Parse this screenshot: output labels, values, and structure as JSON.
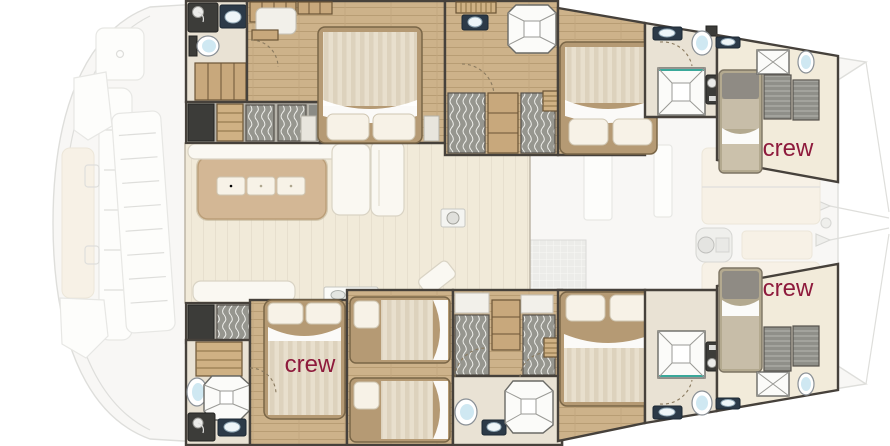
{
  "plan": {
    "labels": {
      "port_forepeak": "crew",
      "starboard_forepeak": "crew",
      "starboard_forward_cabin": "crew"
    },
    "colors": {
      "crew_text": "#8e1a3c",
      "wood_floor": "#cdb28a",
      "wall": "#46413b",
      "bathroom_floor": "#e9e2d4",
      "salon_floor": "#f1ead9",
      "forepeak_floor": "#f2ebda",
      "table": "#d3b795",
      "upholstery": "#faf8f2",
      "ghost_deck": "#f4f3f0",
      "ghost_line": "#cbcbc6",
      "fixture_navy": "#2c3a48"
    }
  }
}
